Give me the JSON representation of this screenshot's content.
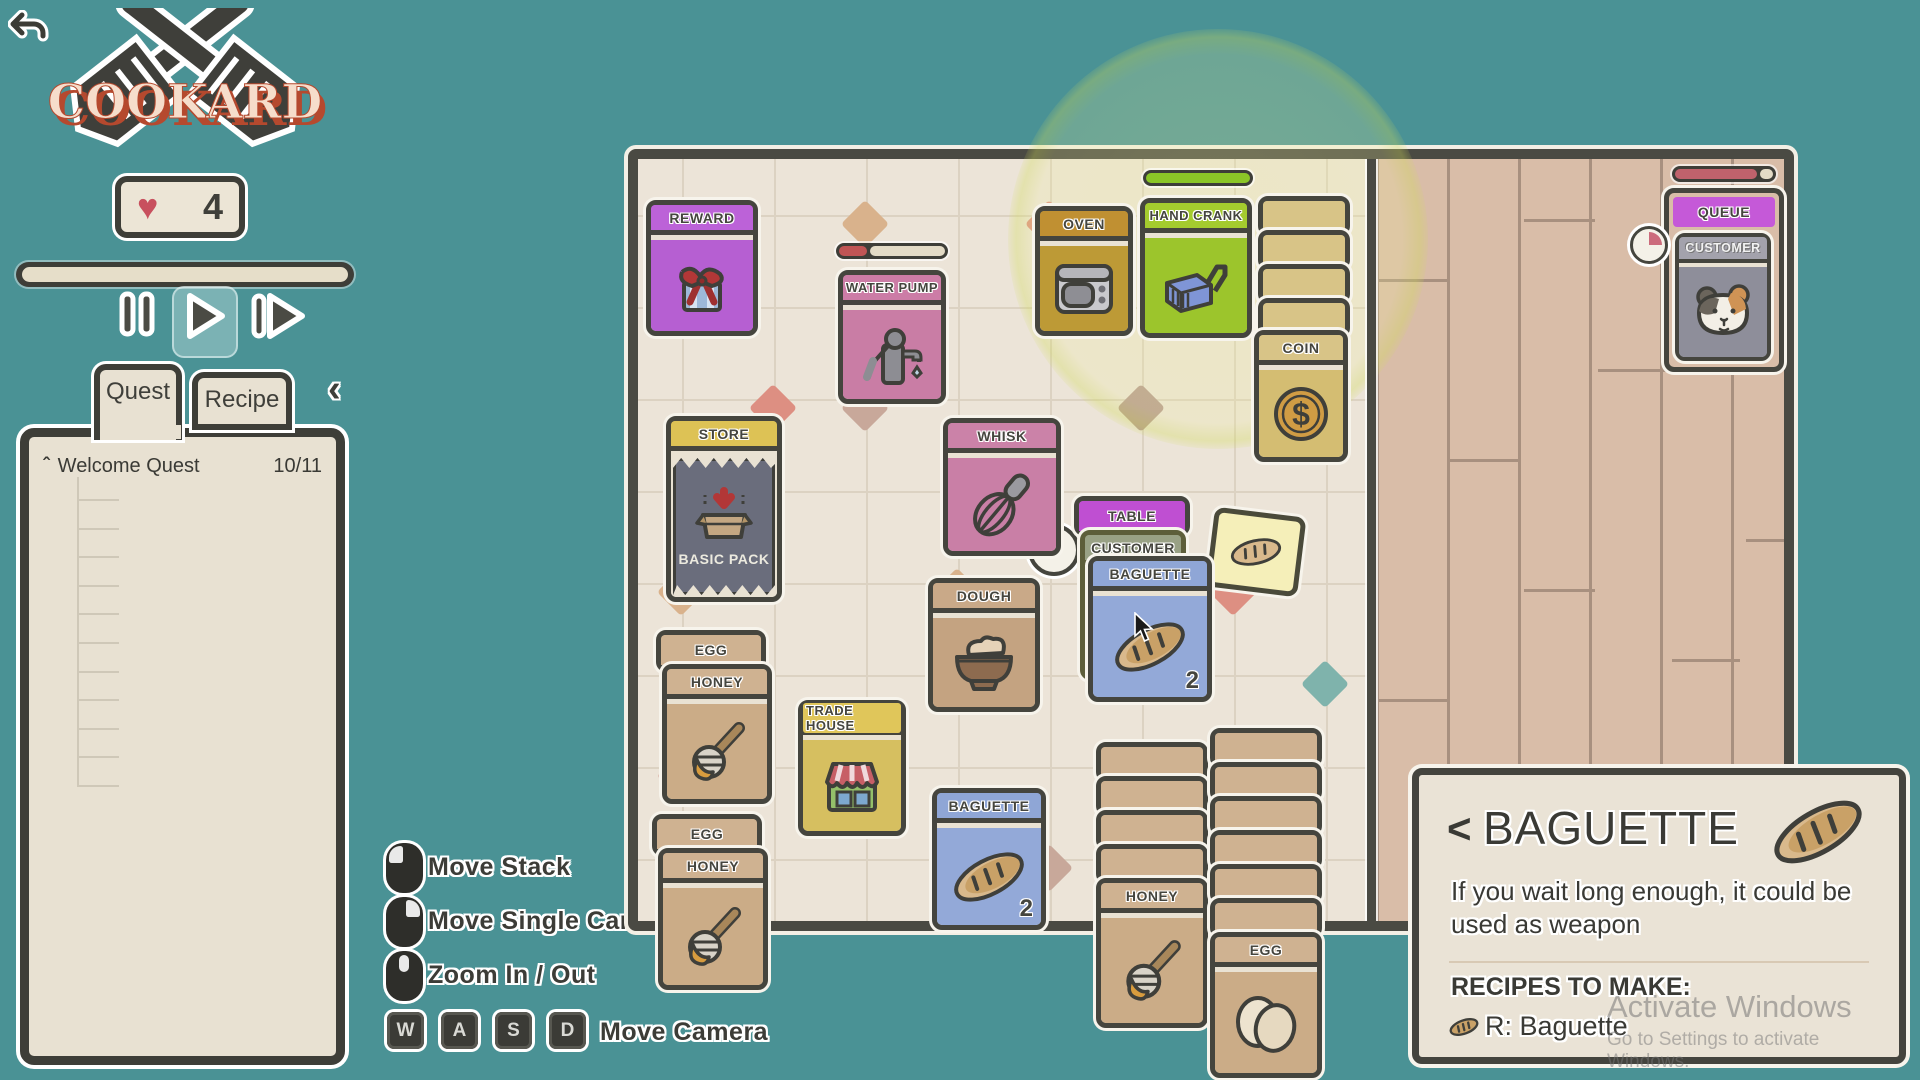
{
  "accent_colors": {
    "teal_bg": "#4a9295",
    "board_dark": "#45453e",
    "cream": "#e9e2d3",
    "purple": "#b65fd2",
    "pink": "#cc7ca6",
    "mustard": "#c09032",
    "green": "#9cc52c",
    "gold": "#d8c487",
    "blue": "#93a9d8",
    "magenta": "#bf4fd2",
    "tan": "#cfb291"
  },
  "hud": {
    "logo_text": "COOKARD",
    "hearts": "4",
    "tabs": {
      "quest": "Quest",
      "recipe": "Recipe"
    },
    "quest": {
      "title": "Welcome Quest",
      "progress": "10/11",
      "items": [
        {
          "label": "Open Start Pack",
          "status": "X"
        },
        {
          "label": "Get Water",
          "status": "X"
        },
        {
          "label": "Make Dough",
          "status": "X"
        },
        {
          "label": "Make Baguette",
          "status": "X"
        },
        {
          "label": "Seat Customer",
          "status": "X"
        },
        {
          "label": "Serve Customer",
          "status": "X"
        },
        {
          "label": "Wash Dish",
          "status": "X"
        },
        {
          "label": "Serve 3 Customers",
          "status": "X"
        },
        {
          "label": "Buy Basic Pack",
          "status": "X"
        },
        {
          "label": "Sell Water",
          "status": ""
        },
        {
          "label": "Make Bagel",
          "status": "X"
        }
      ]
    }
  },
  "controls": {
    "move_stack": "Move Stack",
    "move_single": "Move Single Card",
    "zoom": "Zoom In / Out",
    "move_camera": "Move Camera",
    "keys": {
      "w": "W",
      "a": "A",
      "s": "S",
      "d": "D"
    }
  },
  "board": {
    "cards": {
      "reward": "REWARD",
      "water_pump": "WATER PUMP",
      "oven": "OVEN",
      "hand_crank": "HAND CRANK",
      "coin": "COIN",
      "store": "STORE",
      "basic_pack": "BASIC PACK",
      "whisk": "WHISK",
      "table": "TABLE",
      "customer": "CUSTOMER",
      "baguette": "BAGUETTE",
      "dough": "DOUGH",
      "trade_house": "TRADE HOUSE",
      "egg": "EGG",
      "honey": "HONEY",
      "queue": "QUEUE"
    },
    "counts": {
      "baguette_table": "2",
      "baguette_bottom": "2"
    },
    "stacks": {
      "coins": 5,
      "honey": 5,
      "eggs": 7
    }
  },
  "info_panel": {
    "back": "<",
    "title": "BAGUETTE",
    "description": "If you wait long enough, it could be used as weapon",
    "recipes_heading": "RECIPES TO MAKE:",
    "recipe_entry": "R: Baguette"
  },
  "watermark": {
    "line1": "Activate Windows",
    "line2": "Go to Settings to activate Windows."
  }
}
